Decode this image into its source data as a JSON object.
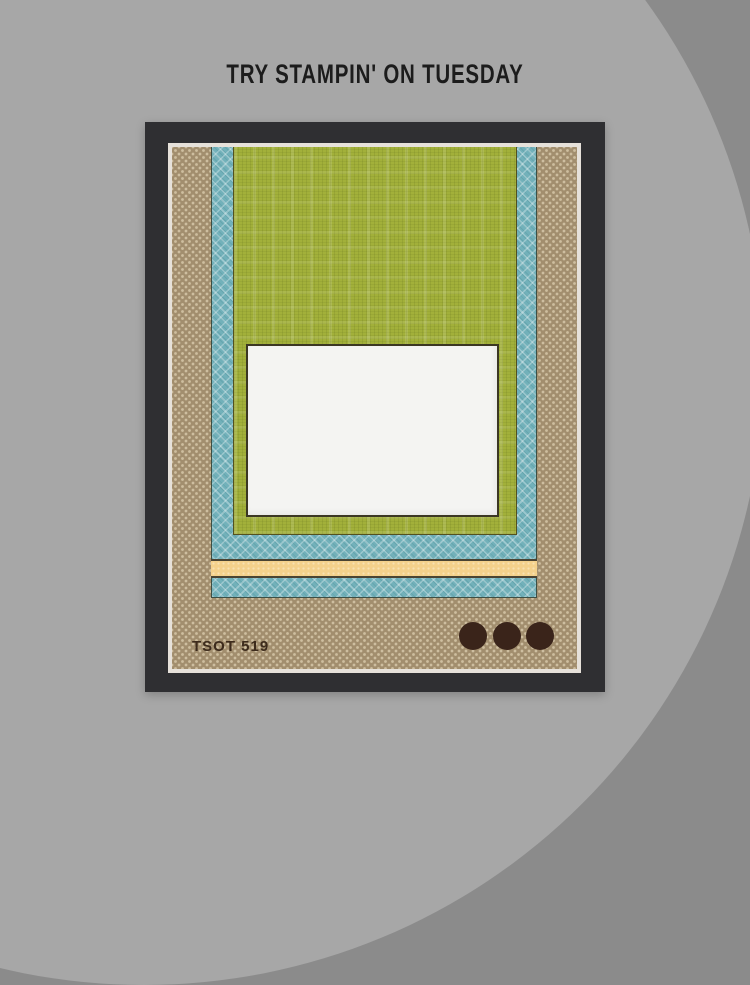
{
  "header": {
    "title": "TRY STAMPIN' ON TUESDAY"
  },
  "sketch": {
    "code": "TSOT 519",
    "embellishment_count": 3,
    "layers": [
      {
        "name": "card-base",
        "pattern": "polka-dot-kraft"
      },
      {
        "name": "lattice-paper",
        "pattern": "diagonal-lattice"
      },
      {
        "name": "linen-paper",
        "pattern": "linen-plaid"
      },
      {
        "name": "focal-panel",
        "pattern": "solid-white"
      },
      {
        "name": "ribbon-strip",
        "pattern": "dotted-cream"
      }
    ]
  },
  "colors": {
    "bg-outer": "#8b8b8b",
    "bg-circle": "#a7a7a7",
    "title": "#1c1c1c",
    "frame": "#2f2f32",
    "mat-line": "#e6e1da",
    "base-tan": "#a28e6e",
    "lattice-blue": "#72b1ba",
    "linen-green": "#a2b03a",
    "focal-white": "#f4f4f2",
    "ribbon-yellow": "#f4d18b",
    "circle-brown": "#3a241a",
    "code-text": "#3d2b1c"
  }
}
